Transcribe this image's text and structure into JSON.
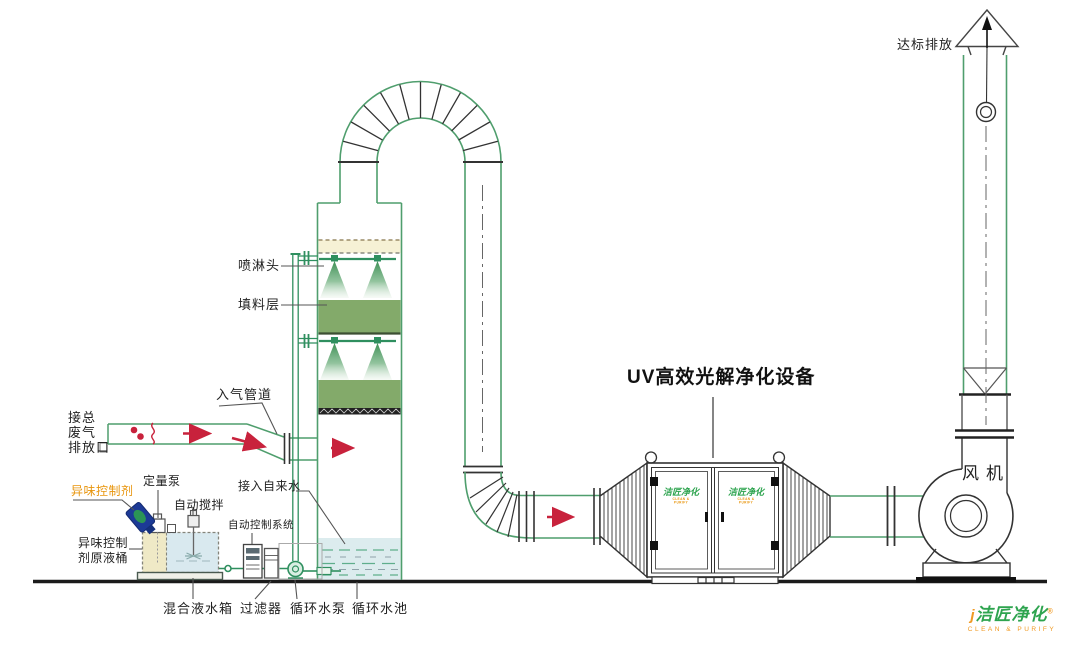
{
  "labels": {
    "discharge": "达标排放",
    "spray_head": "喷淋头",
    "packing_layer": "填料层",
    "gas_inlet_pipe": "入气管道",
    "tap_water": "接入自来水",
    "auto_control_system": "自动控制系统",
    "waste_gas": {
      "l1": "接总",
      "l2": "废气",
      "l3": "排放口"
    },
    "odor_control_agent": "异味控制剂",
    "metering_pump": "定量泵",
    "auto_stirrer": "自动搅拌",
    "agent_barrel": {
      "l1": "异味控制",
      "l2": "剂原液桶"
    },
    "mixing_tank": "混合液水箱",
    "filter": "过滤器",
    "circulating_pump": "循环水泵",
    "circulating_pool": "循环水池",
    "uv_unit_title": "UV高效光解净化设备",
    "fan": "风机"
  },
  "logo": {
    "mark": "j",
    "name": "洁匠净化",
    "registered": "®",
    "subtitle": "CLEAN & PURIFY"
  },
  "door_logo": {
    "name": "洁匠净化",
    "subtitle": "CLEAN & PURIFY"
  },
  "colors": {
    "pipe_green": "#4f9e6d",
    "packing_green": "#83aa6a",
    "pool_blue": "#dcecee",
    "tank_beige": "#efe9c6",
    "tank_blue": "#d9e9ef",
    "arrow_red": "#c8223c",
    "label_orange": "#e8950c",
    "logo_green": "#2ea44f",
    "logo_orange": "#f09a23",
    "bottle_blue": "#1c3a96"
  }
}
